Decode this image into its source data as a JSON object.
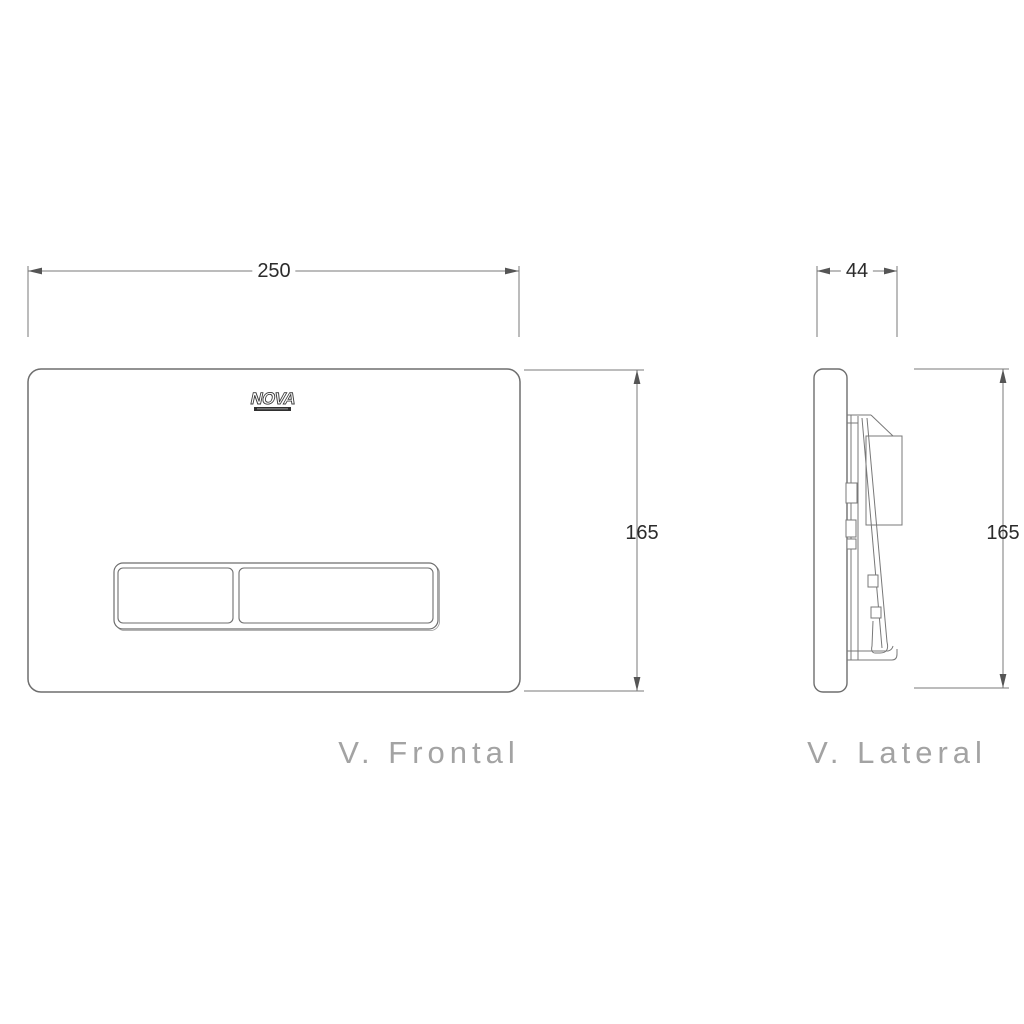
{
  "logo": {
    "text": "NOVA"
  },
  "frontal": {
    "caption": "V. Frontal",
    "width_dim": "250",
    "height_dim": "165"
  },
  "lateral": {
    "caption": "V. Lateral",
    "depth_dim": "44",
    "height_dim": "165"
  },
  "colors": {
    "background": "#ffffff",
    "plate_line": "#6e6e6e",
    "dimension_line": "#7a7a7a",
    "mechanism_line": "#787878",
    "dimension_text": "#2b2b2b",
    "caption_text": "#a3a3a3",
    "logo_outline": "#3b3b3b",
    "logo_bar": "#2f2f2f"
  }
}
